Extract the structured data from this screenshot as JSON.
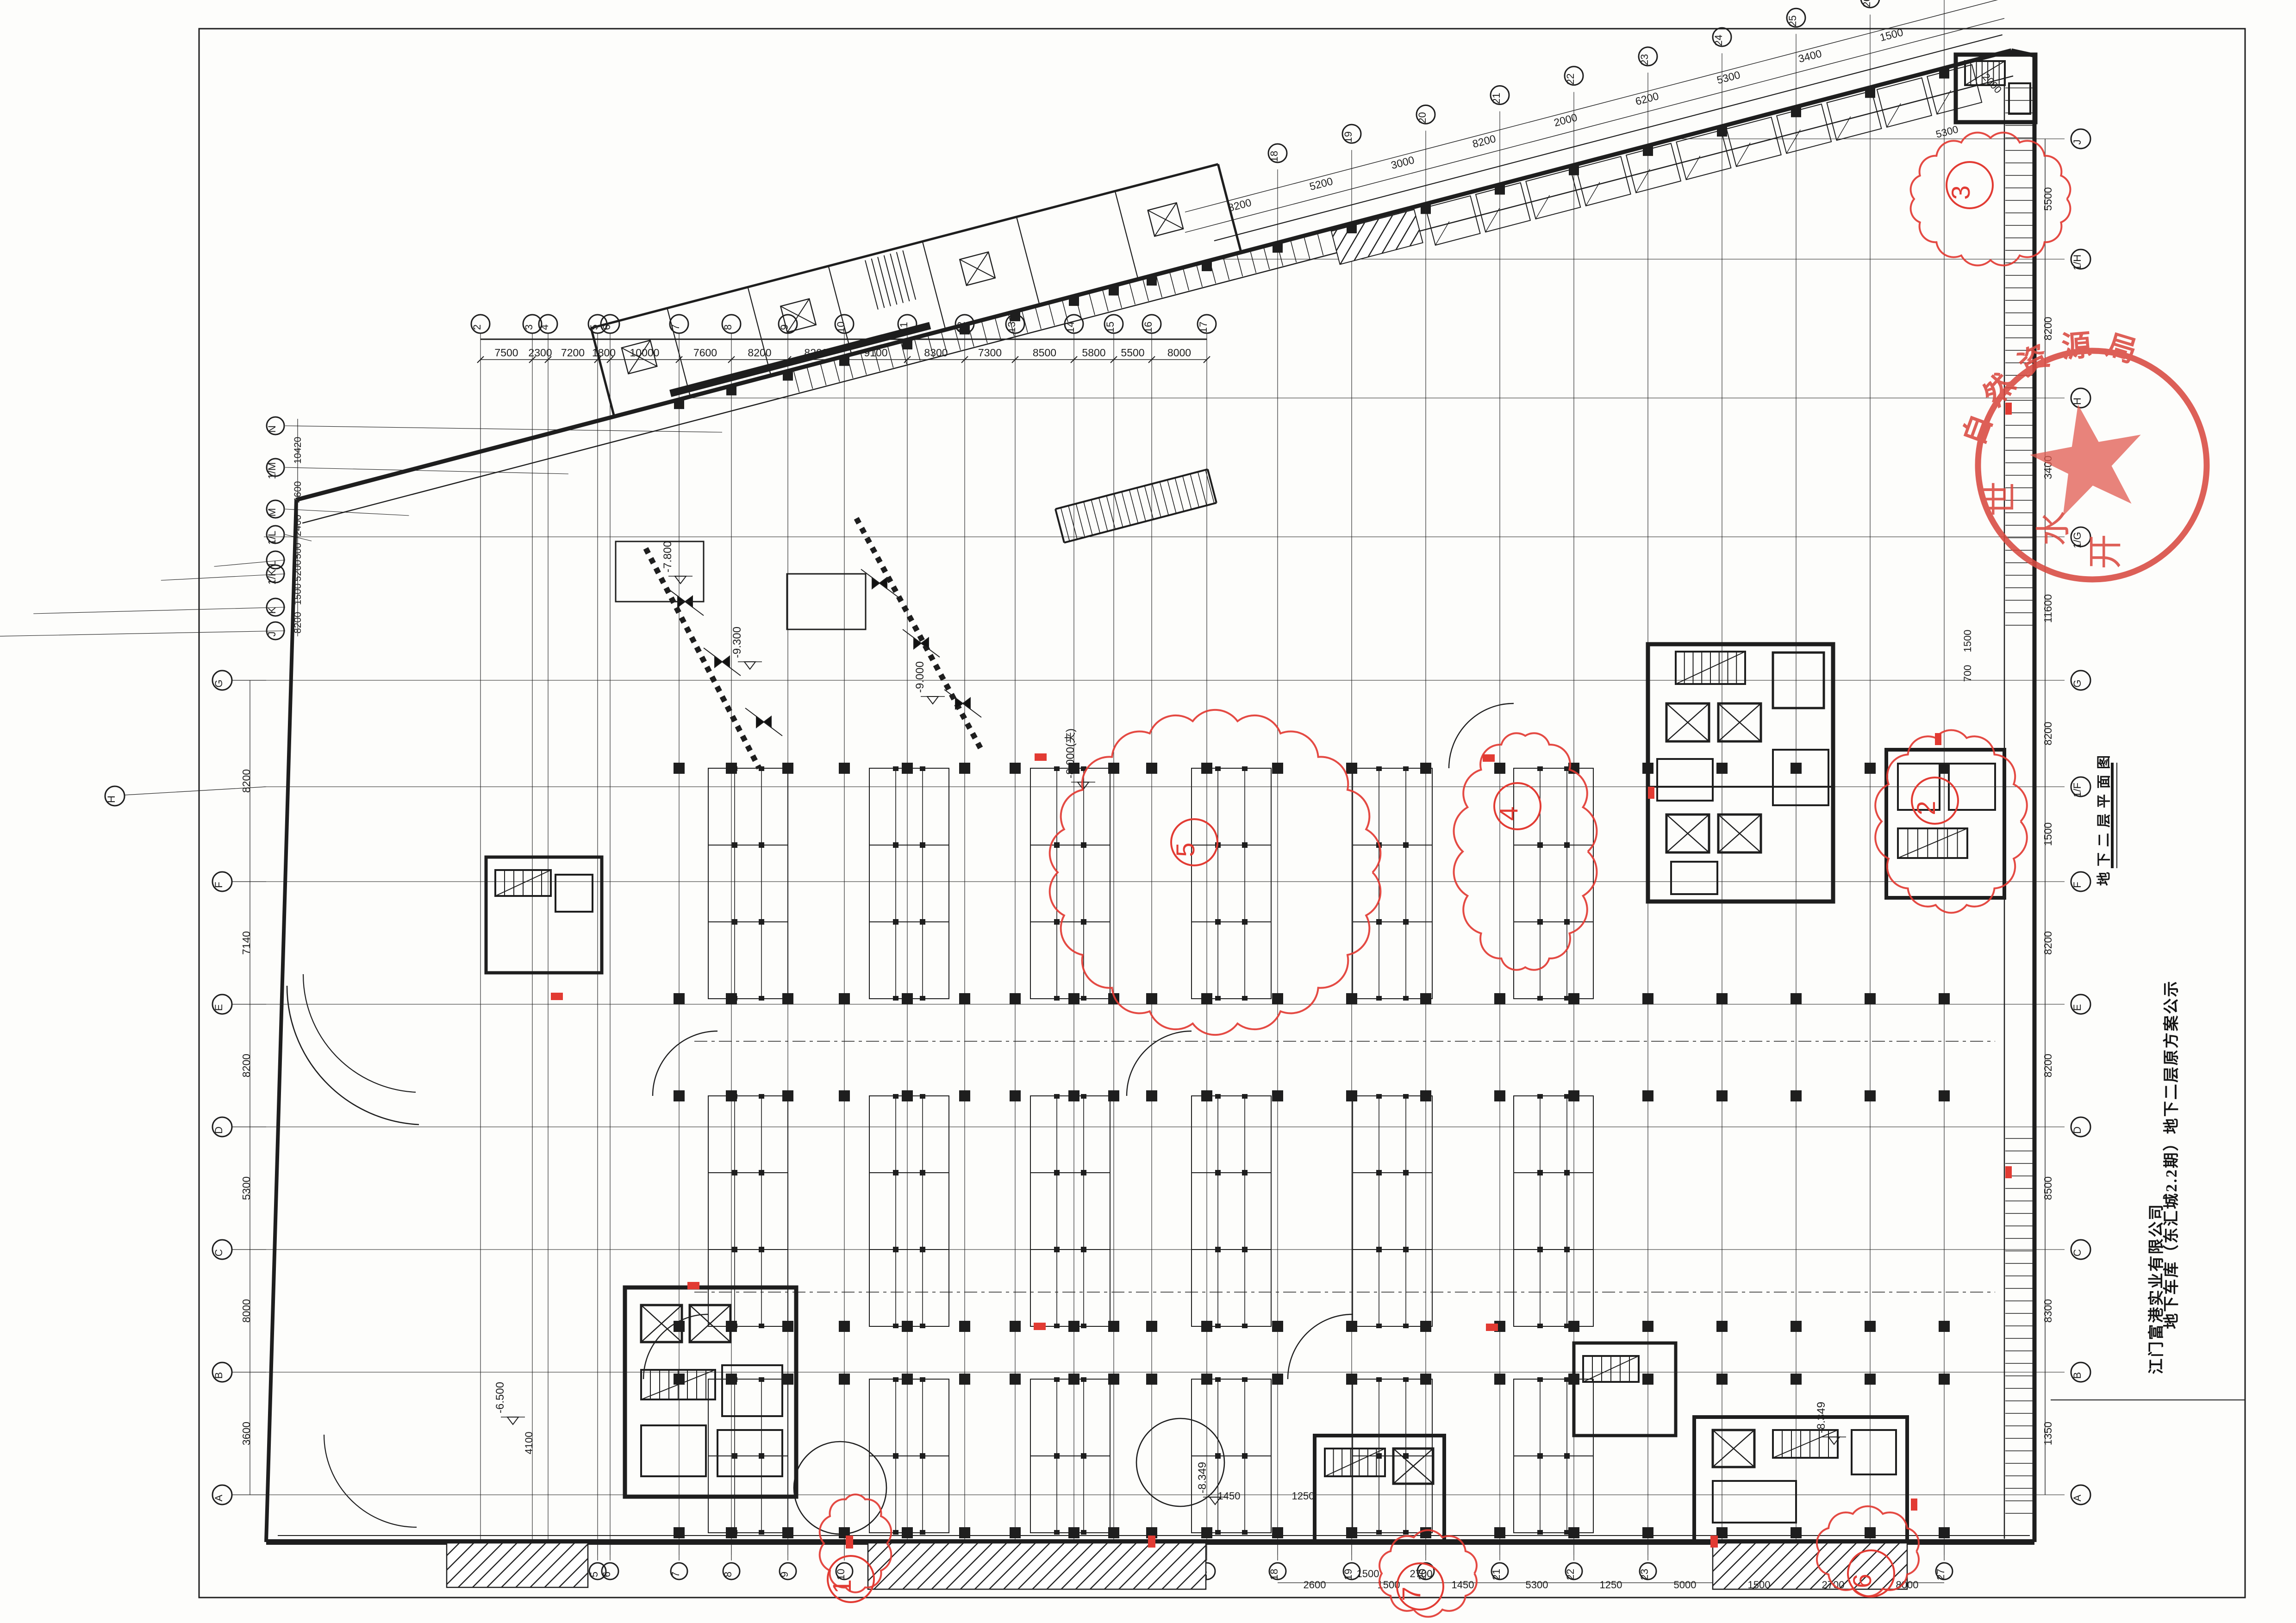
{
  "sheet": {
    "bg": "#fdfdfb",
    "frame_color": "#1c1c1c",
    "line_color": "#1e1e1e",
    "red": "#e23b33"
  },
  "titles": {
    "company": "江门富港实业有限公司",
    "project": "地下车库（东汇城2.2期）地下二层原方案公示",
    "drawing_label": "地下二层平面图"
  },
  "stamp": {
    "arc_text": "自然资源局",
    "bottom_chars": [
      "世",
      "水",
      "开"
    ],
    "ring_color": "#d84a41",
    "star_color": "#e05a50",
    "text_color": "#da4a41"
  },
  "axes": {
    "top": {
      "labels": [
        "2",
        "3",
        "4",
        "5",
        "6",
        "7",
        "8",
        "9",
        "10",
        "11",
        "12",
        "13",
        "14",
        "15",
        "16",
        "17"
      ],
      "dims": [
        "7500",
        "2300",
        "7200",
        "1800",
        "10000",
        "7600",
        "8200",
        "8200",
        "9100",
        "8300",
        "7300",
        "8500",
        "5800",
        "5500",
        "8000"
      ]
    },
    "diag": {
      "labels": [
        "18",
        "19",
        "20",
        "21",
        "22",
        "23",
        "24",
        "25",
        "26",
        "27"
      ],
      "dims": [
        "8200",
        "5200",
        "3000",
        "8200",
        "2000",
        "6200",
        "5300",
        "3400",
        "1500"
      ]
    },
    "bottom_dims": [
      "2600",
      "1500",
      "1450",
      "5300",
      "1250",
      "5000",
      "1500",
      "2700",
      "8000",
      "5500"
    ],
    "right": {
      "labels": [
        "J",
        "1/H",
        "H",
        "1/G",
        "G",
        "1/F",
        "F",
        "E",
        "D",
        "C",
        "B",
        "A"
      ],
      "dims": [
        "5500",
        "8200",
        "3400",
        "11600",
        "8200",
        "1500",
        "8200",
        "8200",
        "8500",
        "8300",
        "1350"
      ]
    },
    "left_wing": {
      "labels": [
        "N",
        "1/M",
        "M",
        "1/L",
        "L",
        "1/K",
        "K",
        "J"
      ],
      "dims": [
        "10420",
        "4600",
        "2400",
        "500",
        "5200",
        "1500",
        "8200"
      ]
    },
    "left_main": {
      "labels": [
        "G",
        "F",
        "E",
        "D",
        "C",
        "B",
        "A"
      ],
      "dims": [
        "8200",
        "7140",
        "8200",
        "5300",
        "8000",
        "3600"
      ]
    }
  },
  "annotations": {
    "levels": [
      "-7.800",
      "-9.300",
      "-9.000",
      "-8.000(夹)",
      "-8.349",
      "-6.500",
      "-8.349"
    ],
    "cloud_numbers": [
      "3",
      "5",
      "4",
      "2",
      "1",
      "7",
      "6"
    ],
    "small_dims": [
      "5300",
      "2000",
      "1500",
      "700",
      "4100",
      "1450",
      "1250",
      "2700",
      "1500"
    ]
  }
}
